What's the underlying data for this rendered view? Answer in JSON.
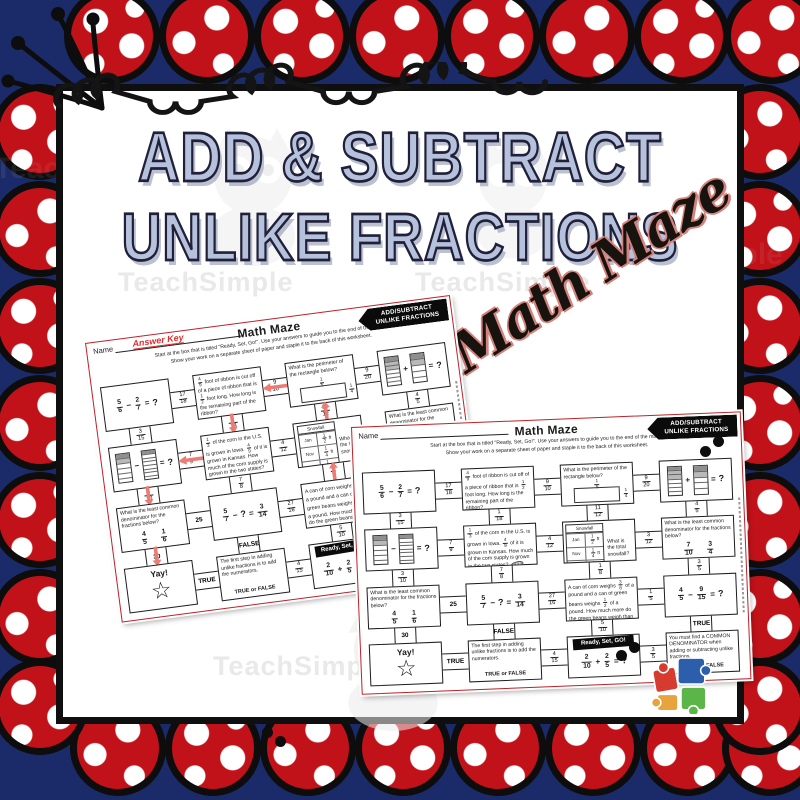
{
  "palette": {
    "navy_background": "#1b2b6a",
    "scallop_red": "#c01218",
    "outline_black": "#0d0d0d",
    "title_periwinkle": "#b6c2dc",
    "script_outline_red": "#d4827c",
    "answer_key_red": "#e02f2f",
    "path_arrow_pink": "#f2837b",
    "worksheet_border_red": "#bf2026"
  },
  "cover": {
    "title_line1": "ADD & SUBTRACT",
    "title_line2": "UNLIKE FRACTIONS",
    "script_title": "Math Maze",
    "watermark": "TeachSimple"
  },
  "worksheet": {
    "name_label": "Name",
    "answer_key_label": "Answer Key",
    "title": "Math Maze",
    "instructions_line1": "Start at the box that is titled \"Ready, Set, Go!\".  Use your answers to guide you to the end of the maze.",
    "instructions_line2": "Show your work on a separate sheet of paper and staple it to the back of this worksheet.",
    "corner_banner_line1": "ADD/SUBTRACT",
    "corner_banner_line2": "UNLIKE FRACTIONS",
    "boxes": [
      {
        "type": "equation",
        "tokens": [
          "5/6",
          "-",
          "2/7",
          "=",
          "?"
        ]
      },
      {
        "type": "word",
        "text": "{4/9} foot of ribbon is cut off of a piece of ribbon that is {1/2} foot long. How long is the remaining part of the ribbon?"
      },
      {
        "type": "perimeter",
        "text": "What is the perimeter of the rectangle below?",
        "top_label": "1/5",
        "side_label": "1/4"
      },
      {
        "type": "strips",
        "op": "+",
        "result": "?",
        "left_cells": 7,
        "left_shaded": 3,
        "right_cells": 5,
        "right_shaded": 2
      },
      {
        "type": "strips",
        "op": "-",
        "result": "?",
        "left_cells": 6,
        "left_shaded": 2,
        "right_cells": 8,
        "right_shaded": 1
      },
      {
        "type": "word",
        "art": "corn",
        "text": "{1/3} of the corn in the U.S. is grown in Iowa. {4/9} of it is grown in Kansas. How much of the corn supply is grown in the two states?"
      },
      {
        "type": "snowfall",
        "table_title": "Snowfall",
        "unit": "ft",
        "rows": [
          [
            "Jan",
            "1/2"
          ],
          [
            "Nov",
            "1/4"
          ],
          [
            "Dec",
            "1/6"
          ]
        ],
        "question": "What is the total snowfall?"
      },
      {
        "type": "lcd",
        "text": "What is the least common denominator for the fractions below?",
        "fractions": [
          "7/10",
          "3/4"
        ]
      },
      {
        "type": "lcd",
        "text": "What is the least common denominator for the fractions below?",
        "fractions": [
          "4/5",
          "1/6"
        ]
      },
      {
        "type": "equation",
        "tokens": [
          "5/7",
          "-",
          "?",
          "=",
          "3/14"
        ]
      },
      {
        "type": "word",
        "text": "A can of corn weighs {3/8} of a pound and a can of green beans weighs {1/2} of a pound. How much more do the green beans weigh than the corn?"
      },
      {
        "type": "equation",
        "tokens": [
          "4/5",
          "-",
          "9/15",
          "=",
          "?"
        ]
      },
      {
        "type": "yay",
        "text": "Yay!",
        "icon": "star-icon"
      },
      {
        "type": "truefalse",
        "text": "The first step in adding unlike fractions is to add the numerators.",
        "prompt": "TRUE or FALSE"
      },
      {
        "type": "start",
        "banner": "Ready, Set, GO!",
        "tokens": [
          "2/10",
          "+",
          "2/5",
          "=",
          "?"
        ]
      },
      {
        "type": "truefalse",
        "text": "You must find a COMMON DENOMINATOR when adding or subtracting unlike fractions.",
        "prompt": "TRUE or FALSE"
      }
    ],
    "h_connectors": [
      [
        "17/18",
        "9/10",
        "9/20"
      ],
      [
        "7/9",
        "4/12",
        "3/12"
      ],
      [
        "25",
        "27/16",
        "1/5"
      ],
      [
        "TRUE",
        "4/15",
        "3/5"
      ]
    ],
    "v_connectors": [
      [
        "3/15",
        "1/18",
        "11/12",
        "4/5"
      ],
      [
        "3/10",
        "7/8",
        "1/8",
        "3/5"
      ],
      [
        "30",
        "FALSE",
        "5/10",
        "TRUE"
      ]
    ],
    "answer_path_arrows": [
      {
        "kind": "h",
        "row": 0,
        "index": 1,
        "dir": "left"
      },
      {
        "kind": "v",
        "row": 0,
        "index": 1,
        "dir": "down"
      },
      {
        "kind": "v",
        "row": 0,
        "index": 2,
        "dir": "up"
      },
      {
        "kind": "h",
        "row": 1,
        "index": 0,
        "dir": "left"
      },
      {
        "kind": "v",
        "row": 1,
        "index": 0,
        "dir": "down"
      },
      {
        "kind": "v",
        "row": 1,
        "index": 2,
        "dir": "up"
      },
      {
        "kind": "v",
        "row": 2,
        "index": 0,
        "dir": "down"
      },
      {
        "kind": "v",
        "row": 2,
        "index": 3,
        "dir": "up"
      },
      {
        "kind": "h",
        "row": 2,
        "index": 2,
        "dir": "left"
      },
      {
        "kind": "h",
        "row": 3,
        "index": 2,
        "dir": "right"
      }
    ]
  }
}
